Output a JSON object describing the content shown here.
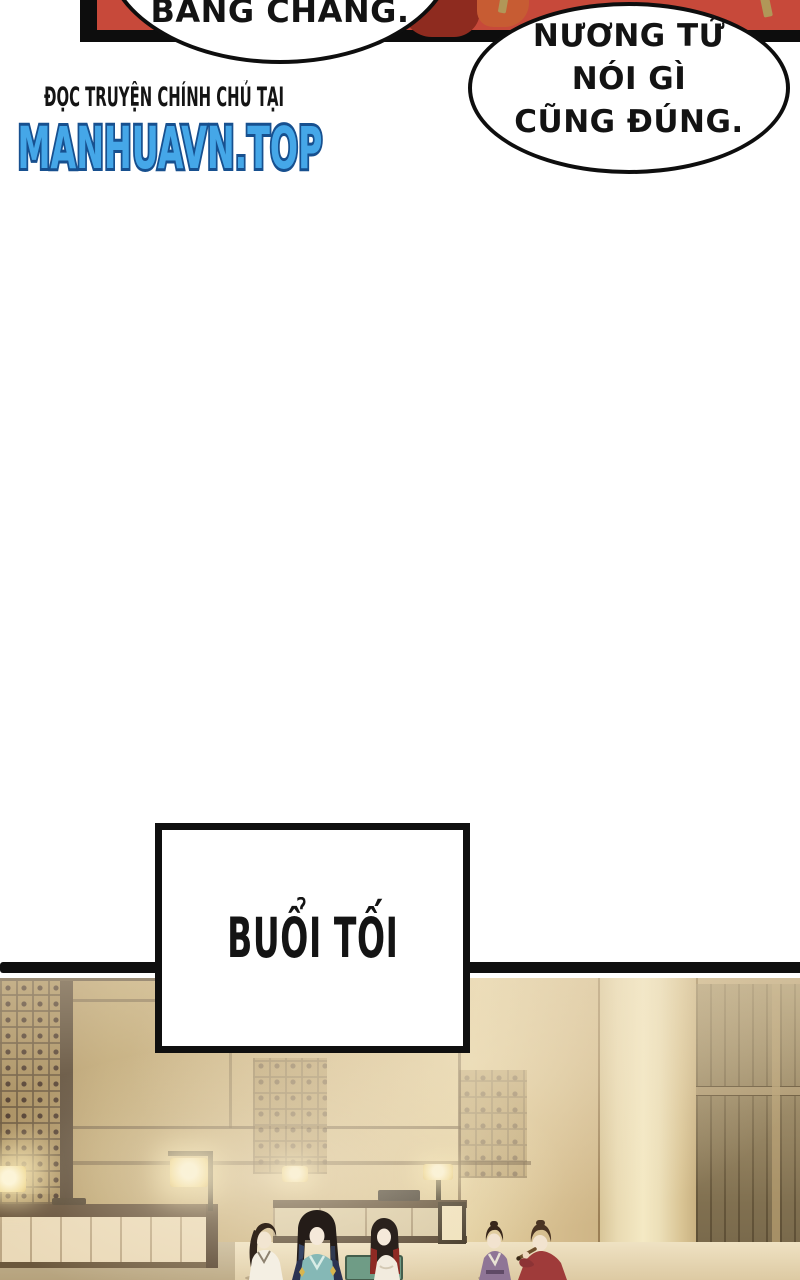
{
  "bubbles": {
    "left": "BẰNG CHÀNG.",
    "right_lines": [
      "NƯƠNG TỬ",
      "NÓI GÌ",
      "CŨNG ĐÚNG."
    ]
  },
  "watermark": {
    "tagline": "ĐỌC TRUYỆN CHÍNH CHỦ TẠI",
    "site": "MANHUAVN.TOP",
    "site_fill": "#45a7e8",
    "site_outline": "#17508f"
  },
  "caption": {
    "text": "BUỔI TỐI"
  },
  "colors": {
    "ink": "#0f0f0f",
    "panel_red": "#c7493a",
    "scene_wall_tan": "#cbb383",
    "scene_floor": "#efe2c3",
    "lamp_glow": "#f3df9f",
    "robe_teal": "#7fb2b2",
    "robe_navy": "#2b3352",
    "robe_purple": "#8f7596",
    "robe_red": "#9f3b3a",
    "hair_red_tips": "#8f2a24",
    "bench_green": "#6f9c86"
  }
}
